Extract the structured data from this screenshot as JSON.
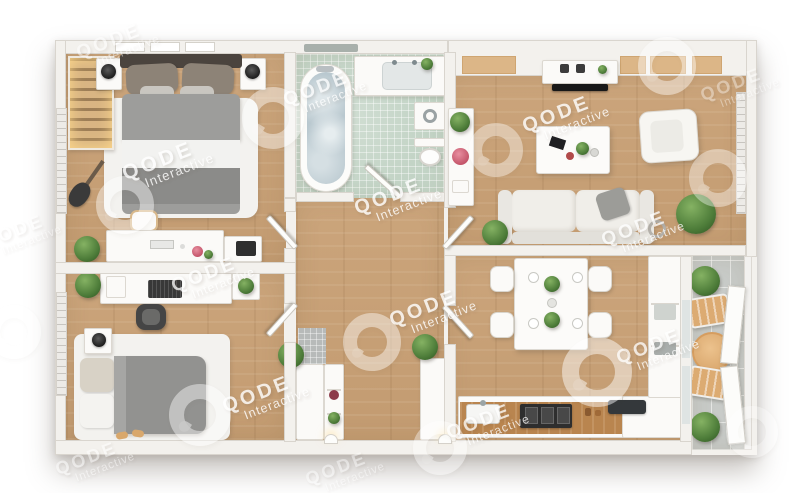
{
  "figure": {
    "type": "3d-floor-plan-top-view",
    "subject": "two-bedroom apartment with balcony"
  },
  "watermark": {
    "brand": "QODE",
    "word": "Interactive"
  },
  "palette": {
    "bg": "#ffffff",
    "wall": "#f3f1ed",
    "wallEdge": "#d9d5ce",
    "wood": "#c9a176",
    "woodDark": "#b9854f",
    "mint": "#c3d4c6",
    "grayTile": "#c8cbc8",
    "rug": "#f3f2ef",
    "white": "#fbfaf8",
    "bedGray": "#9d9d9b",
    "bedDark": "#8b8b89",
    "plant": "#4d7c39",
    "water": "#b9c8cf",
    "dark": "#2e2e2e",
    "terrace": "#dcab72"
  },
  "watermarks": {
    "text": [
      {
        "x": 118,
        "y": 45,
        "s": 1.0,
        "o": 0.5
      },
      {
        "x": 325,
        "y": 92,
        "s": 1.0,
        "o": 0.8
      },
      {
        "x": 566,
        "y": 118,
        "s": 1.05,
        "o": 0.85
      },
      {
        "x": 168,
        "y": 165,
        "s": 1.1,
        "o": 0.85
      },
      {
        "x": 398,
        "y": 200,
        "s": 1.05,
        "o": 0.85
      },
      {
        "x": 643,
        "y": 232,
        "s": 1.0,
        "o": 0.8
      },
      {
        "x": 213,
        "y": 278,
        "s": 1.0,
        "o": 0.8
      },
      {
        "x": 433,
        "y": 312,
        "s": 1.05,
        "o": 0.85
      },
      {
        "x": 658,
        "y": 350,
        "s": 1.0,
        "o": 0.8
      },
      {
        "x": 266,
        "y": 398,
        "s": 1.05,
        "o": 0.85
      },
      {
        "x": 488,
        "y": 425,
        "s": 1.0,
        "o": 0.8
      },
      {
        "x": 95,
        "y": 462,
        "s": 0.95,
        "o": 0.5
      },
      {
        "x": 345,
        "y": 472,
        "s": 0.95,
        "o": 0.45
      },
      {
        "x": 740,
        "y": 88,
        "s": 0.95,
        "o": 0.4
      },
      {
        "x": 22,
        "y": 235,
        "s": 0.95,
        "o": 0.45
      }
    ],
    "rings": [
      {
        "x": 273,
        "y": 118,
        "d": 62,
        "o": 0.5
      },
      {
        "x": 125,
        "y": 205,
        "d": 58,
        "o": 0.5
      },
      {
        "x": 496,
        "y": 150,
        "d": 54,
        "o": 0.45
      },
      {
        "x": 667,
        "y": 66,
        "d": 58,
        "o": 0.5
      },
      {
        "x": 718,
        "y": 178,
        "d": 58,
        "o": 0.45
      },
      {
        "x": 597,
        "y": 372,
        "d": 70,
        "o": 0.55
      },
      {
        "x": 200,
        "y": 415,
        "d": 62,
        "o": 0.5
      },
      {
        "x": 372,
        "y": 342,
        "d": 58,
        "o": 0.5
      },
      {
        "x": 440,
        "y": 448,
        "d": 54,
        "o": 0.45
      },
      {
        "x": 752,
        "y": 432,
        "d": 52,
        "o": 0.35
      },
      {
        "x": 14,
        "y": 332,
        "d": 54,
        "o": 0.35
      }
    ]
  }
}
